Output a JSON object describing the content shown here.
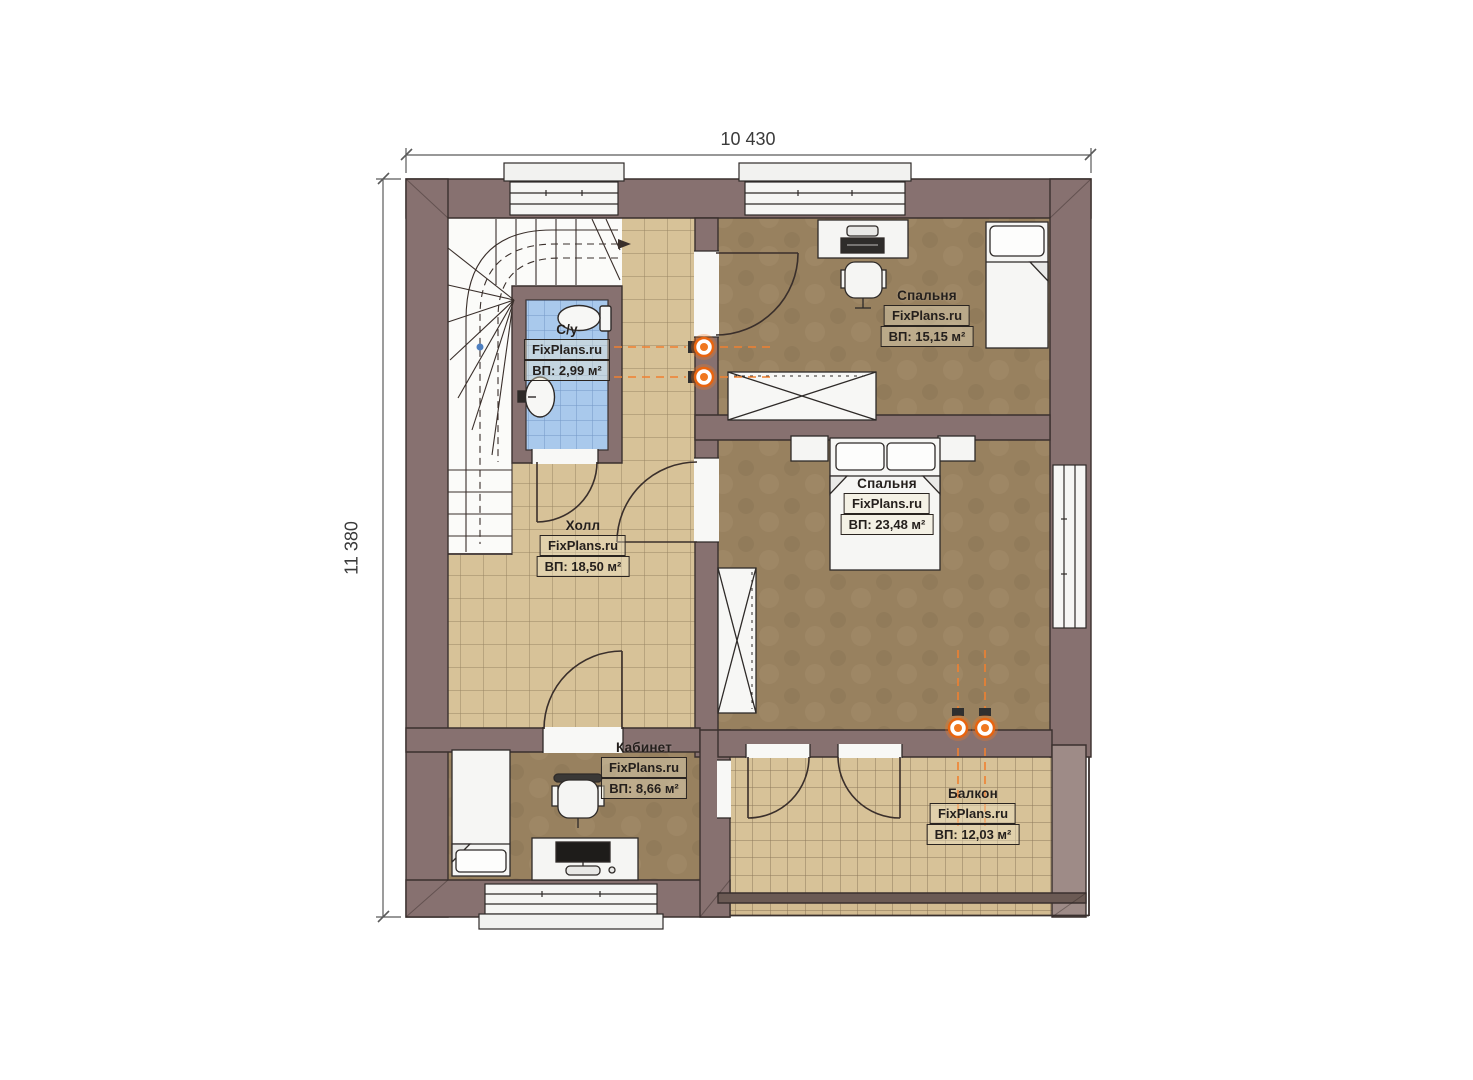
{
  "plan": {
    "dimensions": {
      "width": "10 430",
      "height": "11 380"
    },
    "watermark": "FixPlans.ru",
    "rooms": [
      {
        "key": "bathroom",
        "name": "С/у",
        "area": "ВП: 2,99 м²"
      },
      {
        "key": "bedroom-top",
        "name": "Спальня",
        "area": "ВП: 15,15 м²"
      },
      {
        "key": "bedroom-main",
        "name": "Спальня",
        "area": "ВП: 23,48 м²"
      },
      {
        "key": "hall",
        "name": "Холл",
        "area": "ВП: 18,50 м²"
      },
      {
        "key": "office",
        "name": "Кабинет",
        "area": "ВП: 8,66 м²"
      },
      {
        "key": "balcony",
        "name": "Балкон",
        "area": "ВП: 12,03 м²"
      }
    ],
    "colors": {
      "wall": "#877170",
      "wall_light": "#9e8b87",
      "outline": "#3a302e",
      "floor_tile": "#d7c298",
      "floor_wood": "#98815f",
      "floor_bathroom": "#a9c9ec",
      "furniture": "#f6f6f4",
      "radiator": "#f07820",
      "dimension_text": "#3a3a3a"
    }
  }
}
